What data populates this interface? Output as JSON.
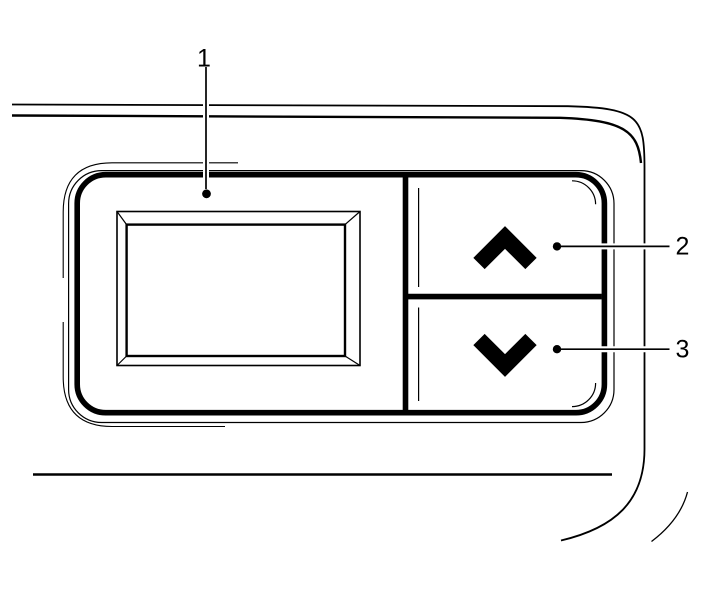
{
  "figure": {
    "type": "technical line illustration",
    "subject": "device control panel with display screen and up/down arrow buttons",
    "background_color": "#ffffff",
    "line_color": "#000000"
  },
  "callouts": [
    {
      "label": "1",
      "target": "display-screen"
    },
    {
      "label": "2",
      "target": "up-arrow-button"
    },
    {
      "label": "3",
      "target": "down-arrow-button"
    }
  ]
}
